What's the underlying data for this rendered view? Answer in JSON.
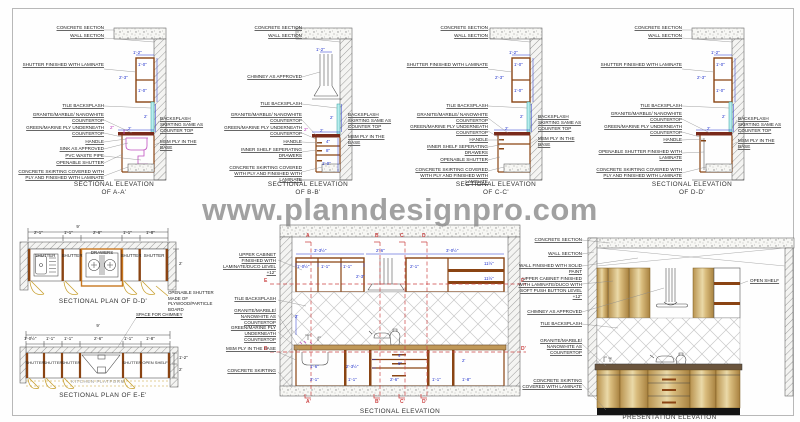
{
  "watermark": "www.planndesignpro.com",
  "colors": {
    "cabinet_brown": "#8a4413",
    "backsplash_cyan": "#b8eeee",
    "counter_maroon": "#7a2a1a",
    "dimension_blue": "#2233cc",
    "section_red": "#cc4444",
    "swing_tan": "#c8a030",
    "wood_light": "#ead9a8"
  },
  "elev_a": {
    "title1": "SECTIONAL ELEVATION",
    "title2": "OF A-A'",
    "labels": [
      "CONCRETE SECTION",
      "WALL SECTION",
      "SHUTTER FINISHED WITH LAMINATE",
      "TILE BACKSPLASH",
      "GRANITE/MARBLE/ NANOWHITE COUNTERTOP",
      "GREEN/MARINE PLY UNDERNEATH COUNTERTOP",
      "HANDLE",
      "SINK AS APPROVED",
      "PVC WASTE PIPE",
      "OPENABLE SHUTTER",
      "CONCRETE SKIRTING COVERED WITH PLY AND FINISHED WITH LAMINATE"
    ],
    "right_labels": [
      "BACKSPLASH SKIRTING SAME AS COUNTER TOP",
      "MSM PLY IN THE BASE"
    ],
    "dims": [
      "1'-2\"",
      "1'-0\"",
      "2'-3\"",
      "1'-0\"",
      "2'",
      "2\"",
      "2'"
    ]
  },
  "elev_b": {
    "title1": "SECTIONAL ELEVATION",
    "title2": "OF B-B'",
    "labels": [
      "CONCRETE SECTION",
      "WALL SECTION",
      "CHIMNEY AS APPROVED",
      "TILE BACKSPLASH",
      "GRANITE/MARBLE/ NANOWHITE COUNTERTOP",
      "GREEN/MARINE PLY UNDERNEATH COUNTERTOP",
      "HANDLE",
      "INNER SHELF SEPERATING DRAWERS",
      "CONCRETE SKIRTING COVERED WITH PLY AND FINISHED WITH LAMINATE"
    ],
    "right_labels": [
      "BACKSPLASH SKIRTING SAME AS COUNTER TOP",
      "MSM PLY IN THE BASE"
    ],
    "dims": [
      "1'-2\"",
      "2'",
      "2\"",
      "4\"",
      "8\"",
      "1'-0\"",
      "2'"
    ]
  },
  "elev_c": {
    "title1": "SECTIONAL ELEVATION",
    "title2": "OF C-C'",
    "labels": [
      "CONCRETE SECTION",
      "WALL SECTION",
      "SHUTTER FINISHED WITH LAMINATE",
      "TILE BACKSPLASH",
      "GRANITE/MARBLE/ NANOWHITE COUNTERTOP",
      "GREEN/MARINE PLY UNDERNEATH COUNTERTOP",
      "HANDLE",
      "INNER SHELF SEPERATING DRAWERS",
      "OPENABLE SHUTTER",
      "CONCRETE SKIRTING COVERED WITH PLY AND FINISHED WITH LAMINATE"
    ],
    "right_labels": [
      "BACKSPLASH SKIRTING SAME AS COUNTER TOP",
      "MSM PLY IN THE BASE"
    ],
    "dims": [
      "1'-2\"",
      "1'-0\"",
      "2'-3\"",
      "1'-0\"",
      "2'",
      "2'"
    ]
  },
  "elev_d": {
    "title1": "SECTIONAL ELEVATION",
    "title2": "OF D-D'",
    "labels": [
      "CONCRETE SECTION",
      "WALL SECTION",
      "SHUTTER FINISHED WITH LAMINATE",
      "TILE BACKSPLASH",
      "GRANITE/MARBLE/ NANOWHITE COUNTERTOP",
      "GREEN/MARINE PLY UNDERNEATH COUNTERTOP",
      "HANDLE",
      "OPENABLE SHUTTER FINISHED WITH LAMINATE",
      "CONCRETE SKIRTING COVERED WITH PLY AND FINISHED WITH LAMINATE"
    ],
    "right_labels": [
      "BACKSPLASH SKIRTING SAME AS COUNTER TOP",
      "MSM PLY IN THE BASE"
    ],
    "dims": [
      "1'-2\"",
      "1'-0\"",
      "2'-3\"",
      "1'-0\"",
      "2'",
      "2'"
    ]
  },
  "plan_d": {
    "title": "SECTIONAL PLAN OF D-D'",
    "total": "9'",
    "segments": [
      "2'-1\"",
      "1'-1\"",
      "2'-6\"",
      "1'-1\"",
      "1'-8\""
    ],
    "depth": "2'",
    "compartments": [
      "SHUTTER",
      "SHUTTER",
      "DRAWERS",
      "SHUTTER",
      "SHUTTER"
    ],
    "note": "OPENABLE SHUTTER MADE OF PLYWOOD/PARTICLE BOARD"
  },
  "plan_e": {
    "title": "SECTIONAL PLAN OF E-E'",
    "total": "9'",
    "segments": [
      "1'-0½\"",
      "1'-1\"",
      "1'-1\"",
      "2'-6\"",
      "1'-1\"",
      "1'-8\""
    ],
    "compartments": [
      "SHUTTER",
      "SHUTTER",
      "SHUTTER",
      "SHUTTER",
      "OPEN SHELF"
    ],
    "chimney_note": "SPACE FOR CHIMNEY",
    "platform": "KITCHEN PLATFORM",
    "side_dims": [
      "1'-2\"",
      "2'"
    ]
  },
  "sec_elev": {
    "title": "SECTIONAL ELEVATION",
    "labels": [
      "UPPER CABINET FINISHED WITH LAMINATE/DUCO LEVEL +12\"",
      "TILE BACKSPLASH",
      "GRANITE/MARBLE/ NANOWHITE AS COUNTERTOP",
      "GREEN/MARINE PLY UNDERNEATH COUNTERTOP",
      "MSM PLY IN THE BASE",
      "CONCRETE SKIRTING"
    ],
    "cuts_top": [
      "A",
      "B",
      "C",
      "D"
    ],
    "cuts_bottom": [
      "A'",
      "B'",
      "C'",
      "D'"
    ],
    "cuts_left": [
      "E",
      "D"
    ],
    "cuts_right": [
      "E'",
      "D'"
    ],
    "dims_upper": [
      "3'-3½\"",
      "2'-6\"",
      "3'-0½\"",
      "1'-0½\"",
      "1'-1\"",
      "1'-1\"",
      "2'-1\"",
      "11½\"",
      "11½\"",
      "2'-3\""
    ],
    "dims_lower": [
      "2'",
      "1'-6\"",
      "2'-3½\"",
      "4\"",
      "8\"",
      "2'",
      "2'-1\"",
      "1'-1\"",
      "2'-6\"",
      "1'-1\"",
      "1'-8\""
    ]
  },
  "pres_elev": {
    "title": "PRESENTATION ELEVATION",
    "labels": [
      "CONCRETE SECTION",
      "WALL SECTION",
      "WALL FINISHED WITH SOLID PAINT",
      "UPPER CABINET FINISHED WITH LAMINATE/DUCO WITH SOFT PUSH BUTTON LEVEL +12\"",
      "CHIMNEY AS APPROVED",
      "TILE BACKSPLASH",
      "GRANITE/MARBLE/ NANOWHITE AS COUNTERTOP",
      "CONCRETE SKIRTING COVERED WITH LAMINATE"
    ],
    "right_label": "OPEN SHELF"
  }
}
